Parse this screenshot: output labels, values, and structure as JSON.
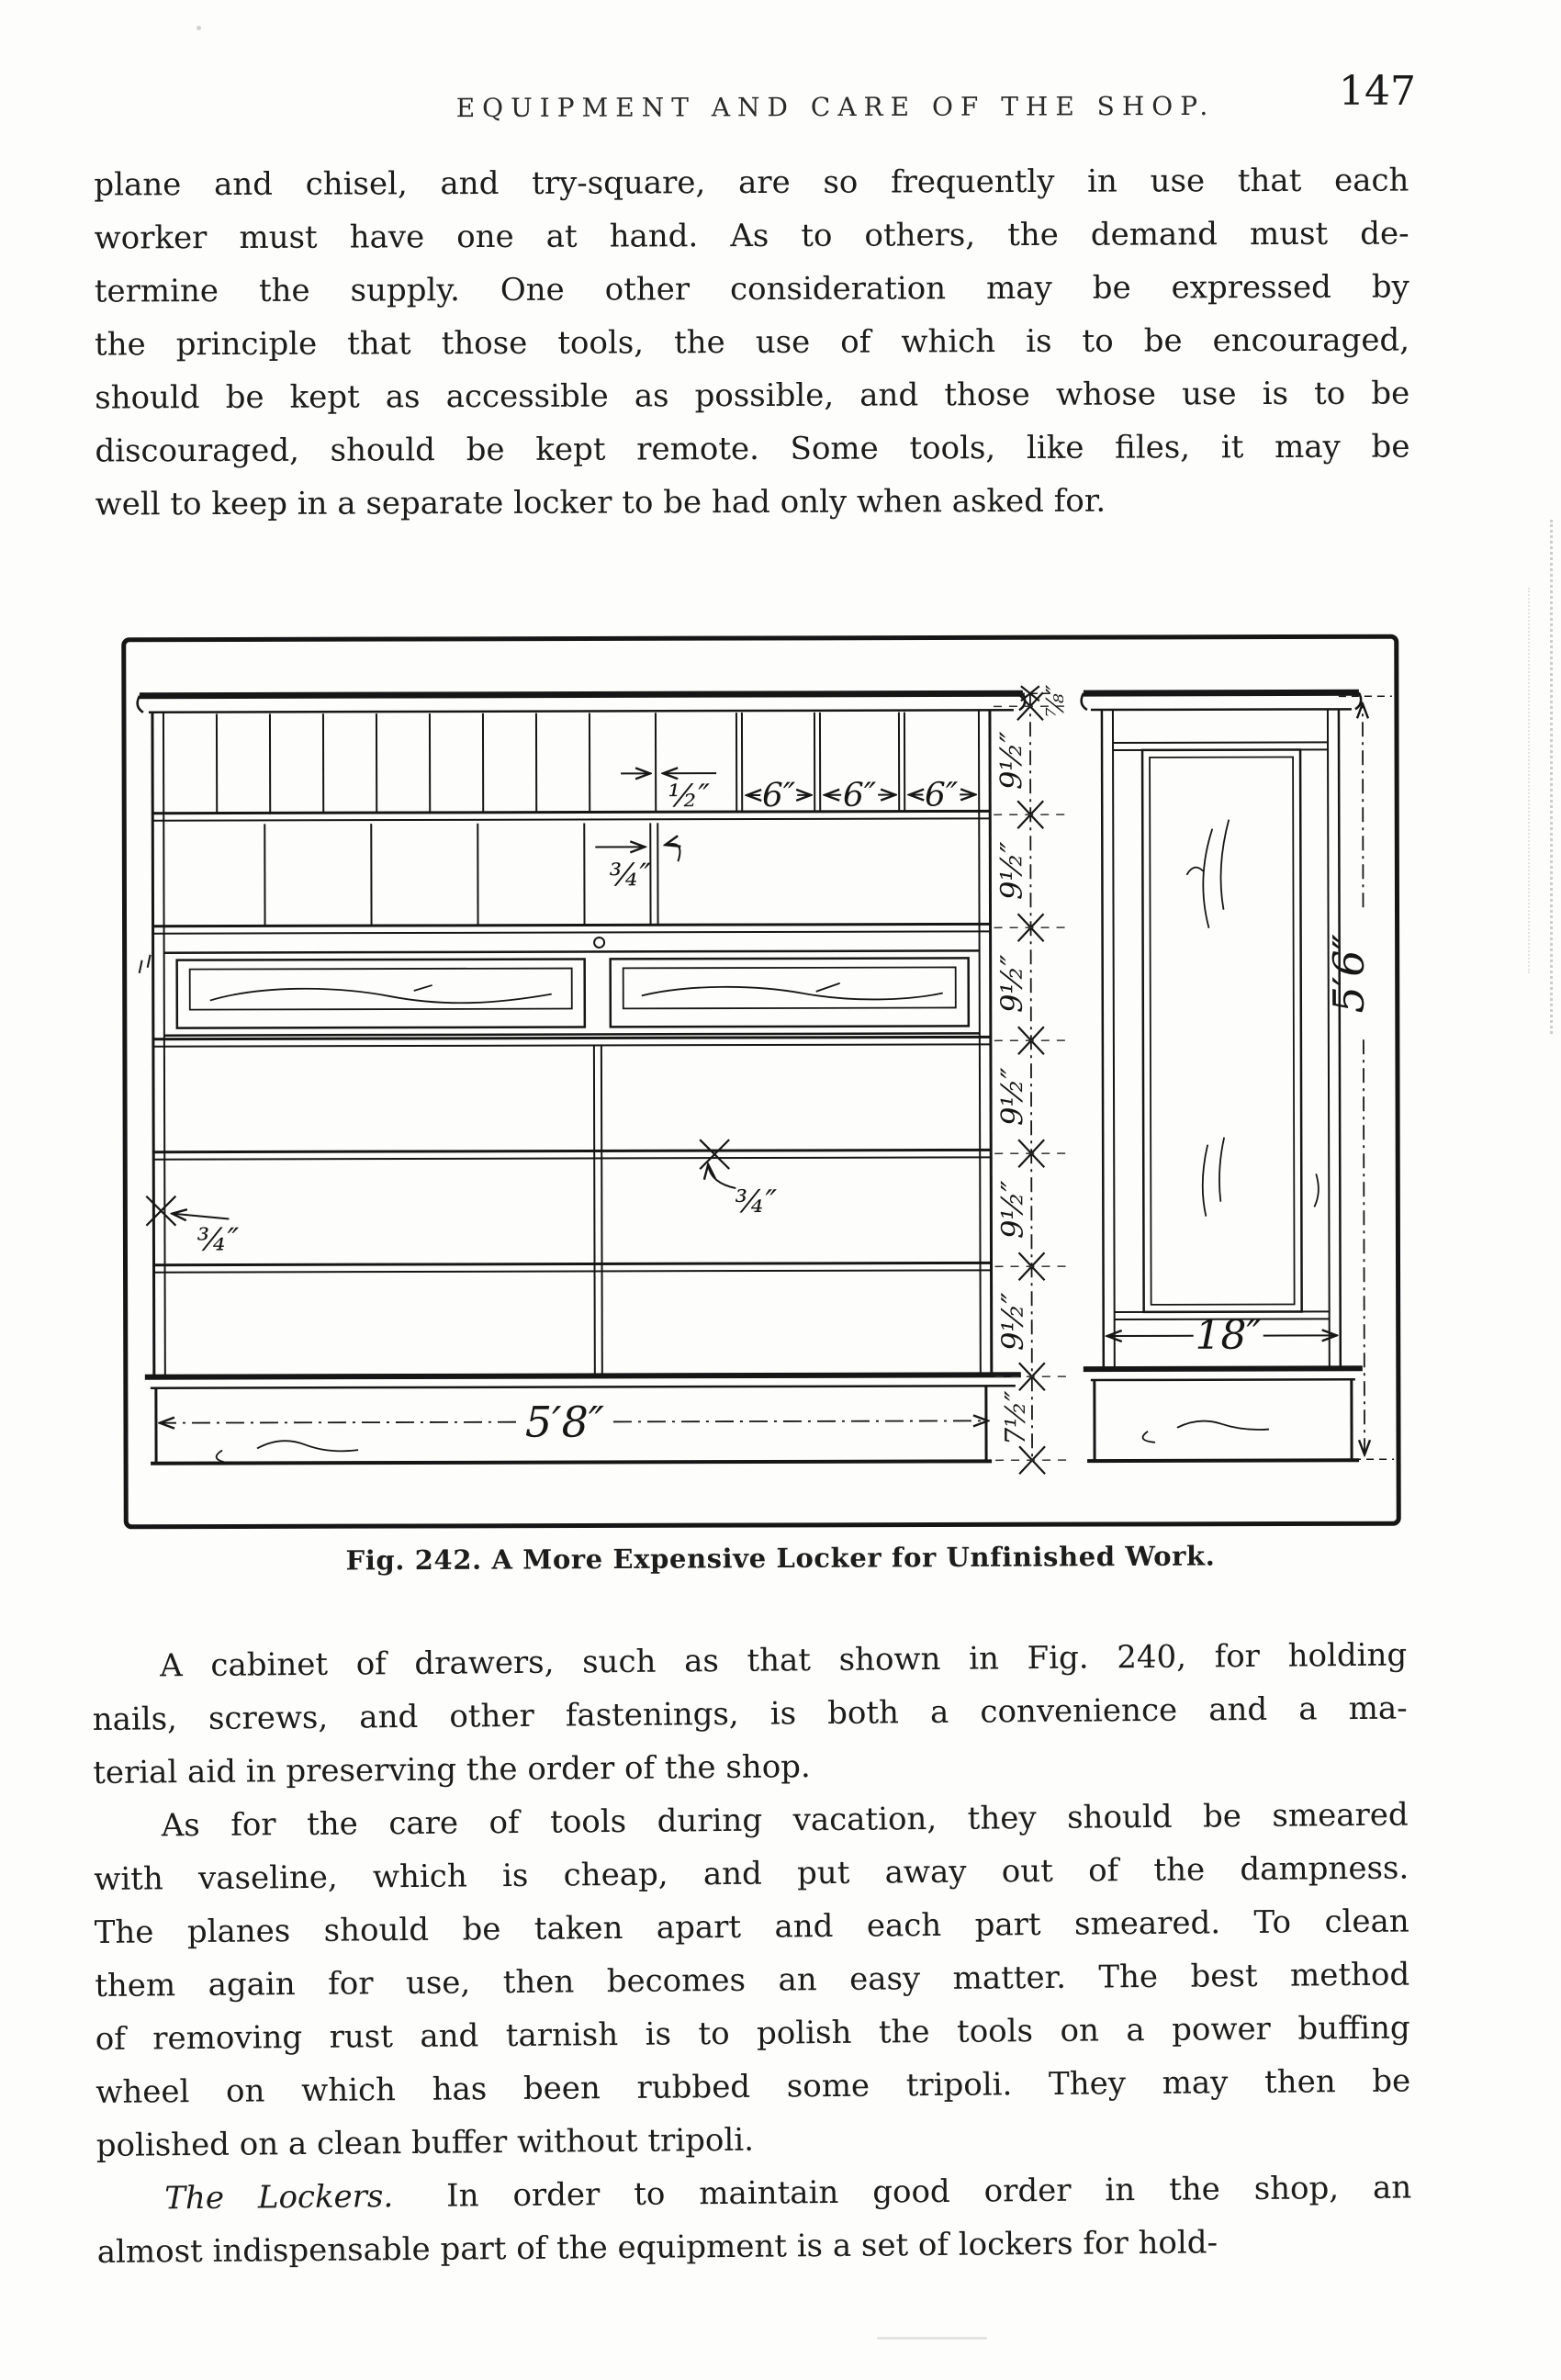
{
  "page": {
    "running_header": "EQUIPMENT AND CARE OF THE SHOP.",
    "page_number": "147"
  },
  "paragraphs": {
    "p1_lines": [
      "plane and chisel, and try-square, are so frequently in use that each",
      "worker must have one at hand.  As to others, the demand must de-",
      "termine the supply.  One other consideration may be expressed by",
      "the principle that those tools, the use of which is to be encouraged,",
      "should be kept as accessible as possible, and those whose use is to be",
      "discouraged, should be kept remote.  Some tools, like files, it may be",
      "well to keep in a separate locker to be had only when asked for."
    ],
    "p2_lines": [
      "A cabinet of drawers, such as that shown in Fig. 240, for holding",
      "nails, screws, and other fastenings, is both a convenience and a ma-",
      "terial aid in preserving the order of the shop."
    ],
    "p3_lines": [
      "As for the care of tools during vacation, they should be smeared",
      "with vaseline, which is cheap, and put away out of the dampness.",
      "The planes should be taken apart and each part smeared.  To clean",
      "them again for use, then becomes an easy matter.  The best method",
      "of removing rust and tarnish is to polish the tools on a power buffing",
      "wheel on which has been rubbed some tripoli.  They may then be",
      "polished on a clean buffer without tripoli."
    ],
    "p4_lead_italic": "The Lockers.",
    "p4_line1_rest": "In order to maintain good order in the shop, an",
    "p4_line2": "almost indispensable part of the equipment is a set of lockers for hold-"
  },
  "figure": {
    "caption": "Fig. 242.  A More Expensive Locker for Unfinished Work.",
    "dimensions": {
      "partition_thickness": "½″",
      "pigeonhole_widths": [
        "6″",
        "6″",
        "6″"
      ],
      "stock_thickness_top": "¾″",
      "stock_thickness_shelf": "¾″",
      "stock_thickness_side": "¾″",
      "overall_width": "5′8″",
      "side_depth": "18″",
      "overall_height": "5′6″",
      "cornice_space": "⅞″",
      "shelf_spacings": [
        "9½″",
        "9½″",
        "9½″",
        "9½″",
        "9½″",
        "9½″"
      ],
      "base_height": "7½″"
    }
  }
}
